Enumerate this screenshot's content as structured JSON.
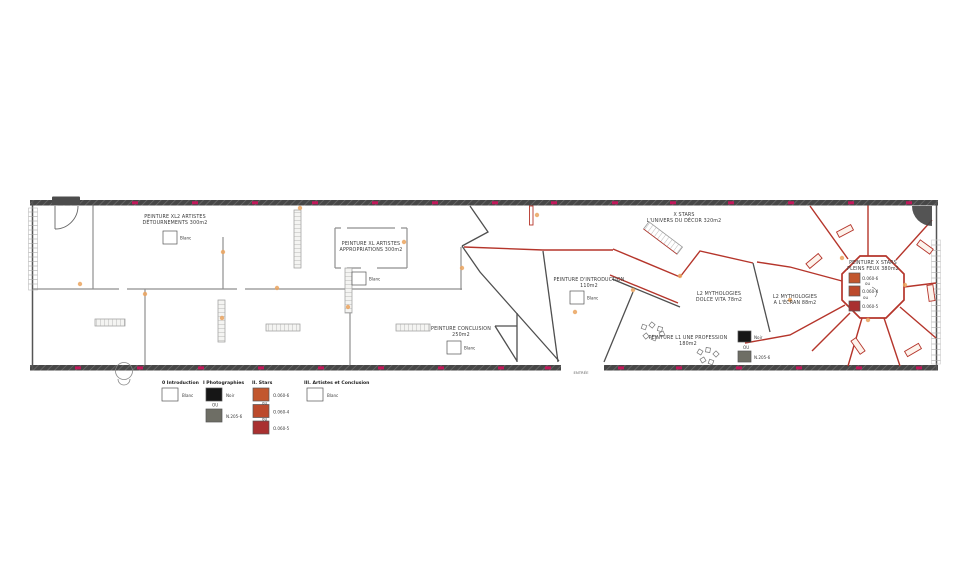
{
  "plan": {
    "rooms": {
      "detournements": {
        "line1": "PEINTURE  XL2 ARTISTES",
        "line2": "DÉTOURNEMENTS 300m2",
        "swatch": "Blanc"
      },
      "appropriations": {
        "line1": "PEINTURE  XL ARTISTES",
        "line2": "APPROPRIATIONS 300m2",
        "swatch": "Blanc"
      },
      "introduction": {
        "line1": "PEINTURE  D'INTRODUCTION",
        "line2": "110m2",
        "swatch": "Blanc"
      },
      "conclusion": {
        "line1": "PEINTURE  CONCLUSION",
        "line2": "250m2",
        "swatch": "Blanc"
      },
      "univers_decor": {
        "line1": "X STARS",
        "line2": "L'UNIVERS DU DÉCOR 320m2"
      },
      "dolce_vita": {
        "line1": "L2 MYTHOLOGIES",
        "line2": "DOLCE VITA 78m2"
      },
      "a_lecran": {
        "line1": "L2 MYTHOLOGIES",
        "line2": "A L'ÉCRAN 88m2"
      },
      "profession": {
        "line1": "PEINTURE  L1 UNE PROFESSION",
        "line2": "180m2",
        "swatches": [
          {
            "color": "#161616",
            "label": "Noir"
          },
          {
            "color": "#6e6e65",
            "label": "N.205-6"
          }
        ],
        "sep": "OU"
      },
      "pleins_feux": {
        "line1": "PEINTURE  X STARS",
        "line2": "PLEINS FEUX 380m2",
        "swatches": [
          {
            "color": "#c2572e",
            "label": "O.060-6"
          },
          {
            "color": "#bc4a2c",
            "label": "O.060-4"
          },
          {
            "color": "#a93030",
            "label": "O.060-5"
          }
        ],
        "seps": [
          "ou",
          "ou"
        ]
      }
    },
    "entrance_label": "ENTRÉE"
  },
  "legend": {
    "columns": [
      {
        "title": "0 Introduction",
        "swatches": [
          {
            "color": "#ffffff",
            "label": "Blanc"
          }
        ],
        "seps": []
      },
      {
        "title": "I Photographies",
        "swatches": [
          {
            "color": "#161616",
            "label": "Noir"
          },
          {
            "color": "#6e6e65",
            "label": "N.205-6"
          }
        ],
        "seps": [
          "OU"
        ]
      },
      {
        "title": "II. Stars",
        "swatches": [
          {
            "color": "#c2572e",
            "label": "O.060-6"
          },
          {
            "color": "#bc4a2c",
            "label": "O.060-4"
          },
          {
            "color": "#a93030",
            "label": "O.060-5"
          }
        ],
        "seps": [
          "ou",
          "ou"
        ]
      },
      {
        "title": "III. Artistes et Conclusion",
        "swatches": [
          {
            "color": "#ffffff",
            "label": "Blanc"
          }
        ],
        "seps": []
      }
    ]
  },
  "colors": {
    "wall_red": "#b5352b",
    "tick_magenta": "#c2185b",
    "door_dot_orange": "#eba45f"
  }
}
